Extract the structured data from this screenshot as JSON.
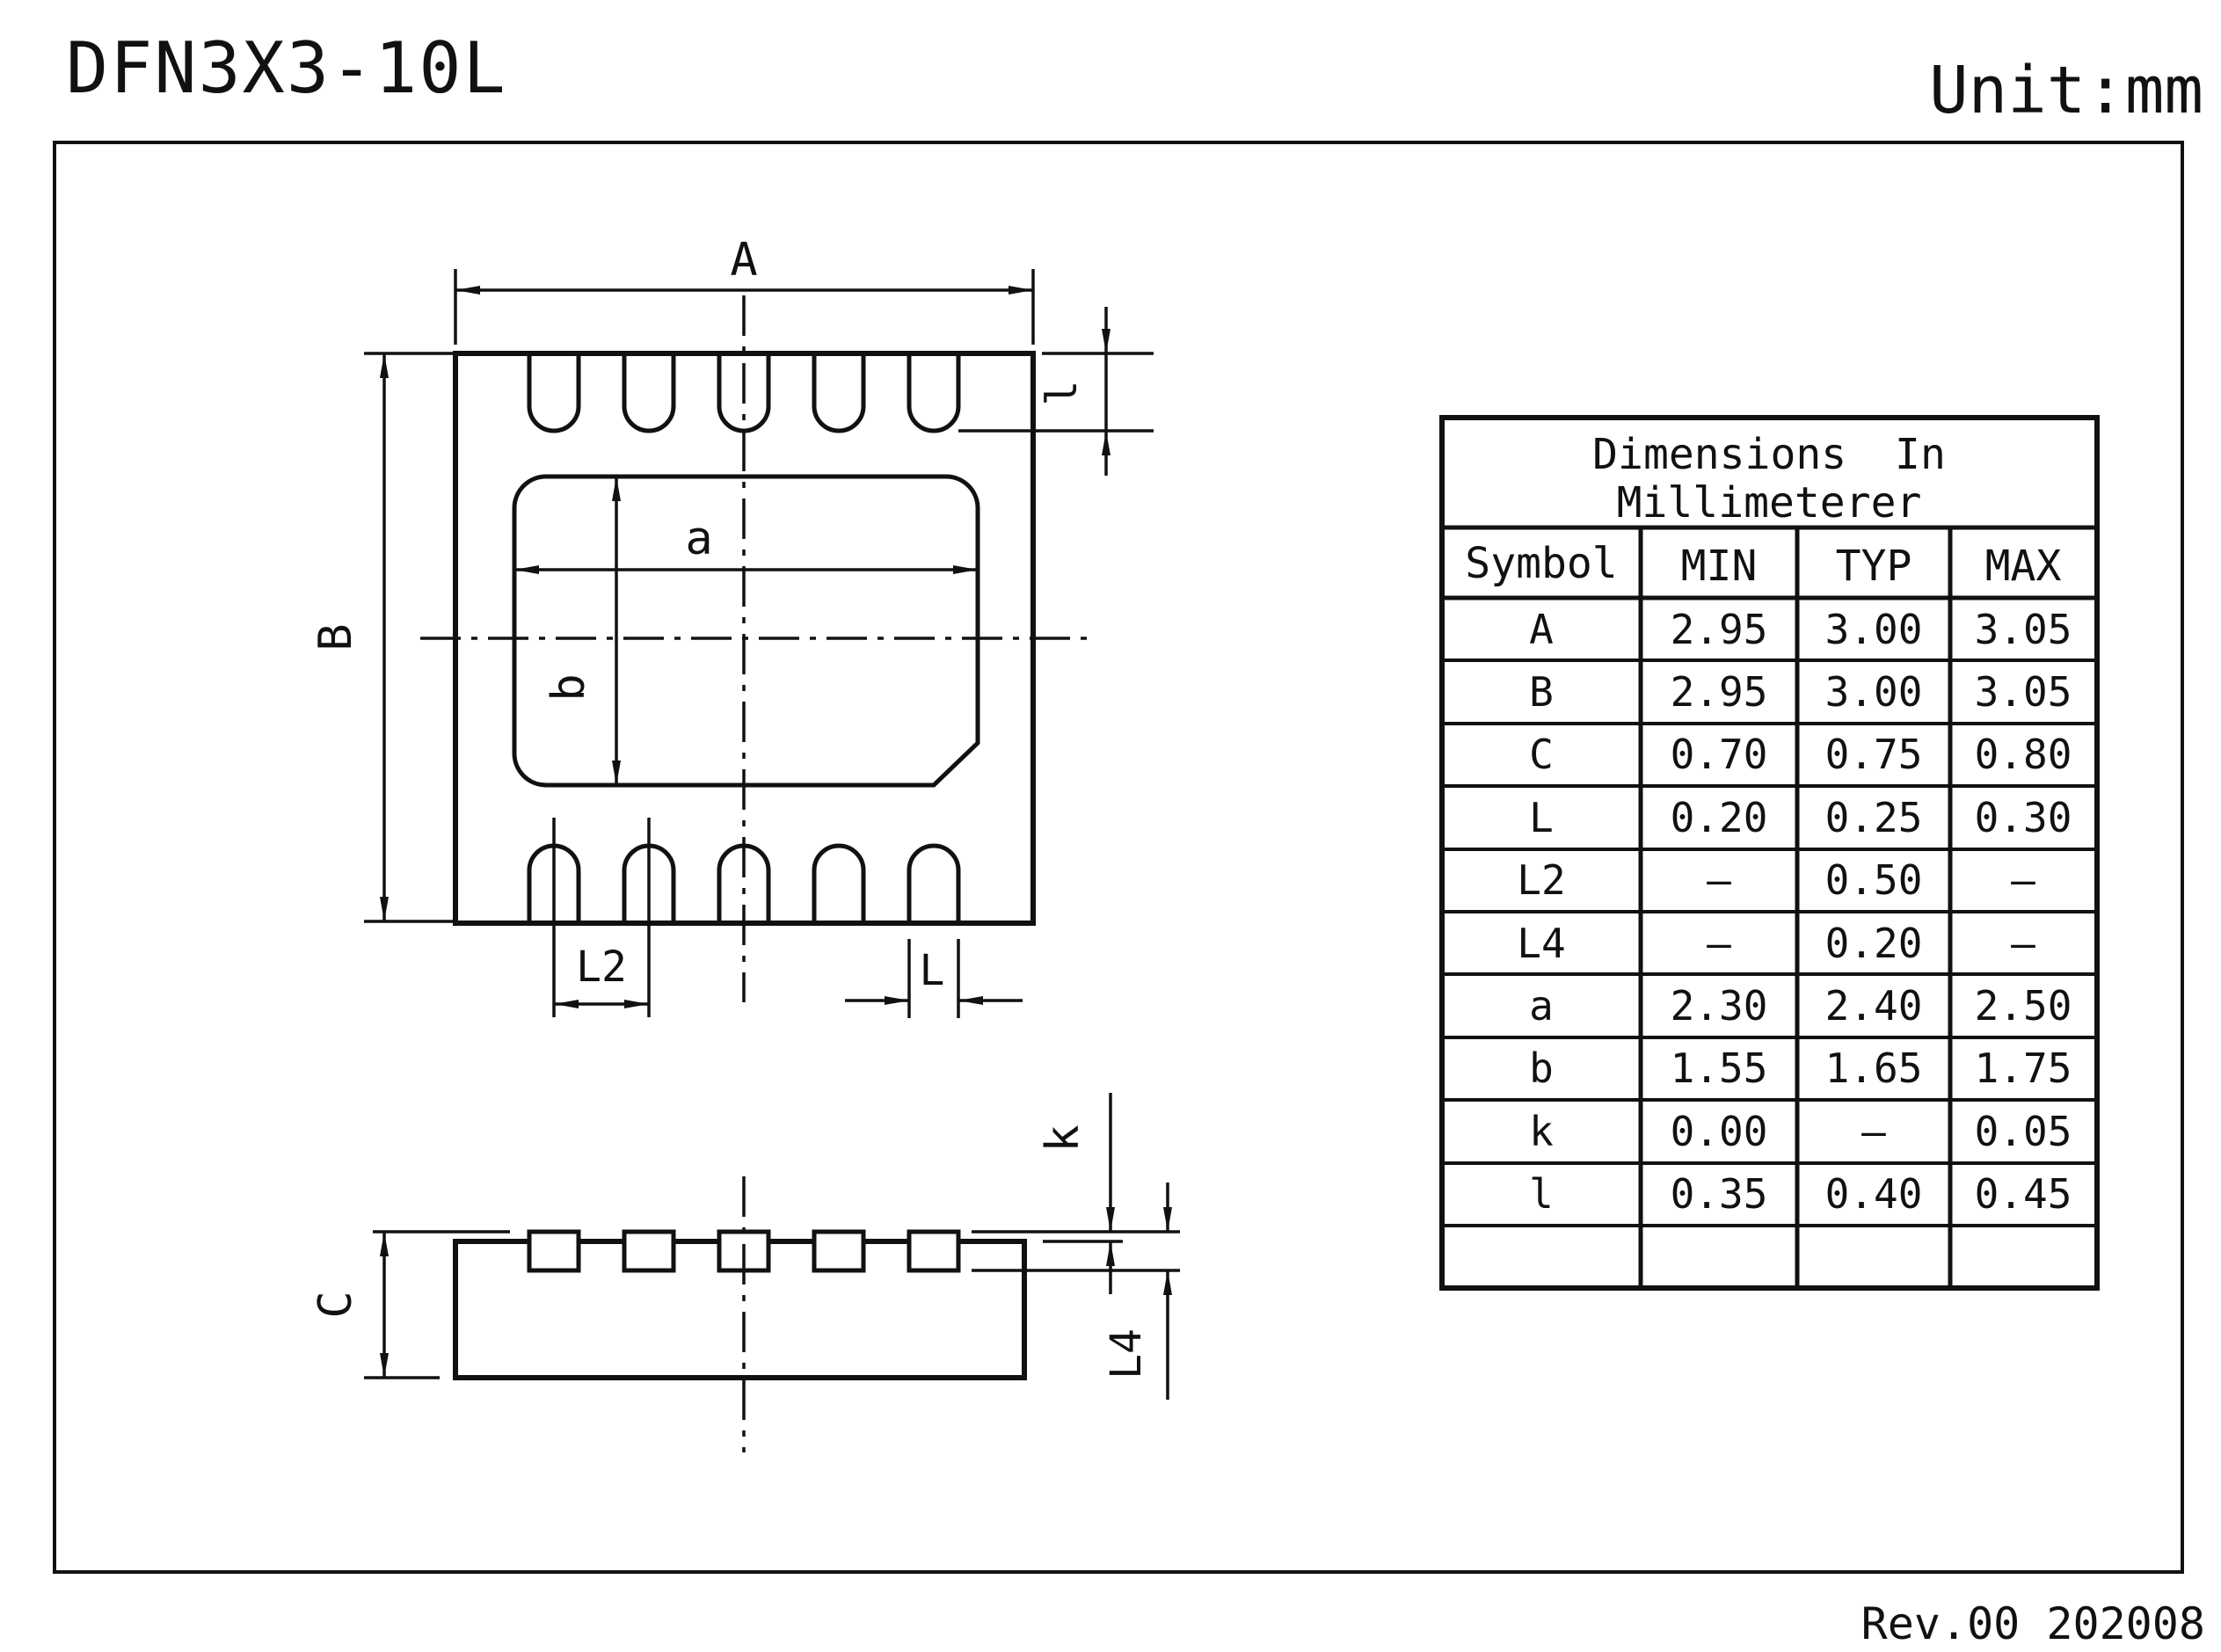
{
  "page": {
    "title": "DFN3X3-10L",
    "unit": "Unit:mm",
    "revision": "Rev.00 202008"
  },
  "labels": {
    "top_view": {
      "A": "A",
      "B": "B",
      "a": "a",
      "b": "b",
      "l": "l",
      "L2": "L2",
      "L": "L"
    },
    "side_view": {
      "C": "C",
      "k": "k",
      "L4": "L4"
    }
  },
  "table": {
    "title_line1": "Dimensions In",
    "title_line2": "Millimeterer",
    "headers": {
      "symbol": "Symbol",
      "min": "MIN",
      "typ": "TYP",
      "max": "MAX"
    },
    "rows": [
      {
        "symbol": "A",
        "min": "2.95",
        "typ": "3.00",
        "max": "3.05"
      },
      {
        "symbol": "B",
        "min": "2.95",
        "typ": "3.00",
        "max": "3.05"
      },
      {
        "symbol": "C",
        "min": "0.70",
        "typ": "0.75",
        "max": "0.80"
      },
      {
        "symbol": "L",
        "min": "0.20",
        "typ": "0.25",
        "max": "0.30"
      },
      {
        "symbol": "L2",
        "min": "–",
        "typ": "0.50",
        "max": "–"
      },
      {
        "symbol": "L4",
        "min": "–",
        "typ": "0.20",
        "max": "–"
      },
      {
        "symbol": "a",
        "min": "2.30",
        "typ": "2.40",
        "max": "2.50"
      },
      {
        "symbol": "b",
        "min": "1.55",
        "typ": "1.65",
        "max": "1.75"
      },
      {
        "symbol": "k",
        "min": "0.00",
        "typ": "–",
        "max": "0.05"
      },
      {
        "symbol": "l",
        "min": "0.35",
        "typ": "0.40",
        "max": "0.45"
      }
    ]
  },
  "colors": {
    "ink": "#111111",
    "background": "#ffffff"
  }
}
